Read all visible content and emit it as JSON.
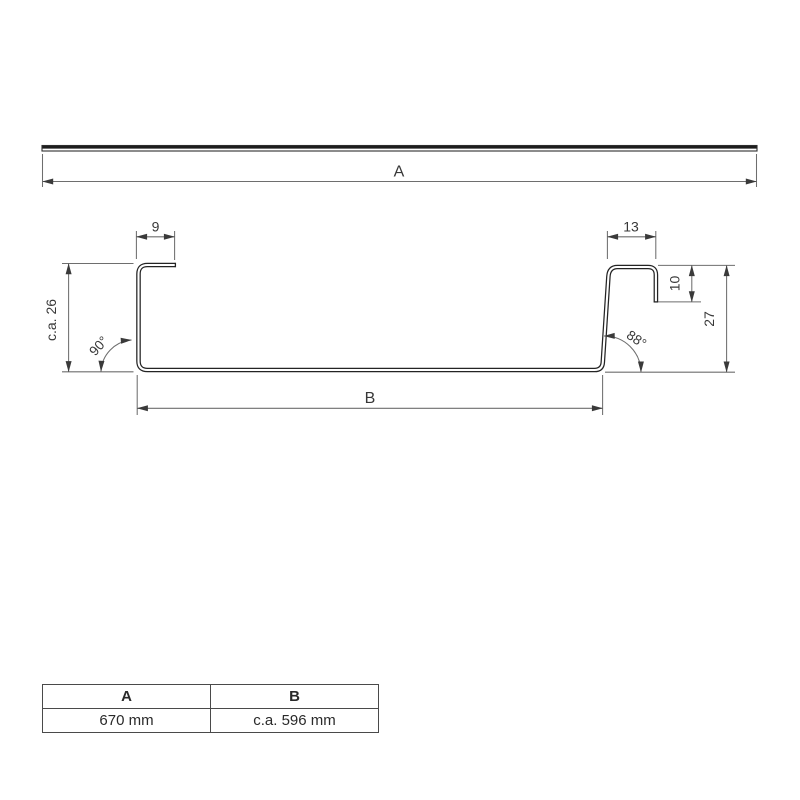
{
  "drawing": {
    "labels": {
      "length_a": "A",
      "width_b": "B",
      "top_left_lip": "9",
      "top_right_cap": "13",
      "right_lip": "10",
      "right_height": "27",
      "left_height": "c.a. 26",
      "left_angle": "90°",
      "right_angle": "88°"
    },
    "colors": {
      "profile_line": "#242424",
      "dimension_line": "#6e6e6e",
      "text": "#383838"
    }
  },
  "table": {
    "headers": [
      "A",
      "B"
    ],
    "rows": [
      [
        "670 mm",
        "c.a. 596 mm"
      ]
    ]
  }
}
